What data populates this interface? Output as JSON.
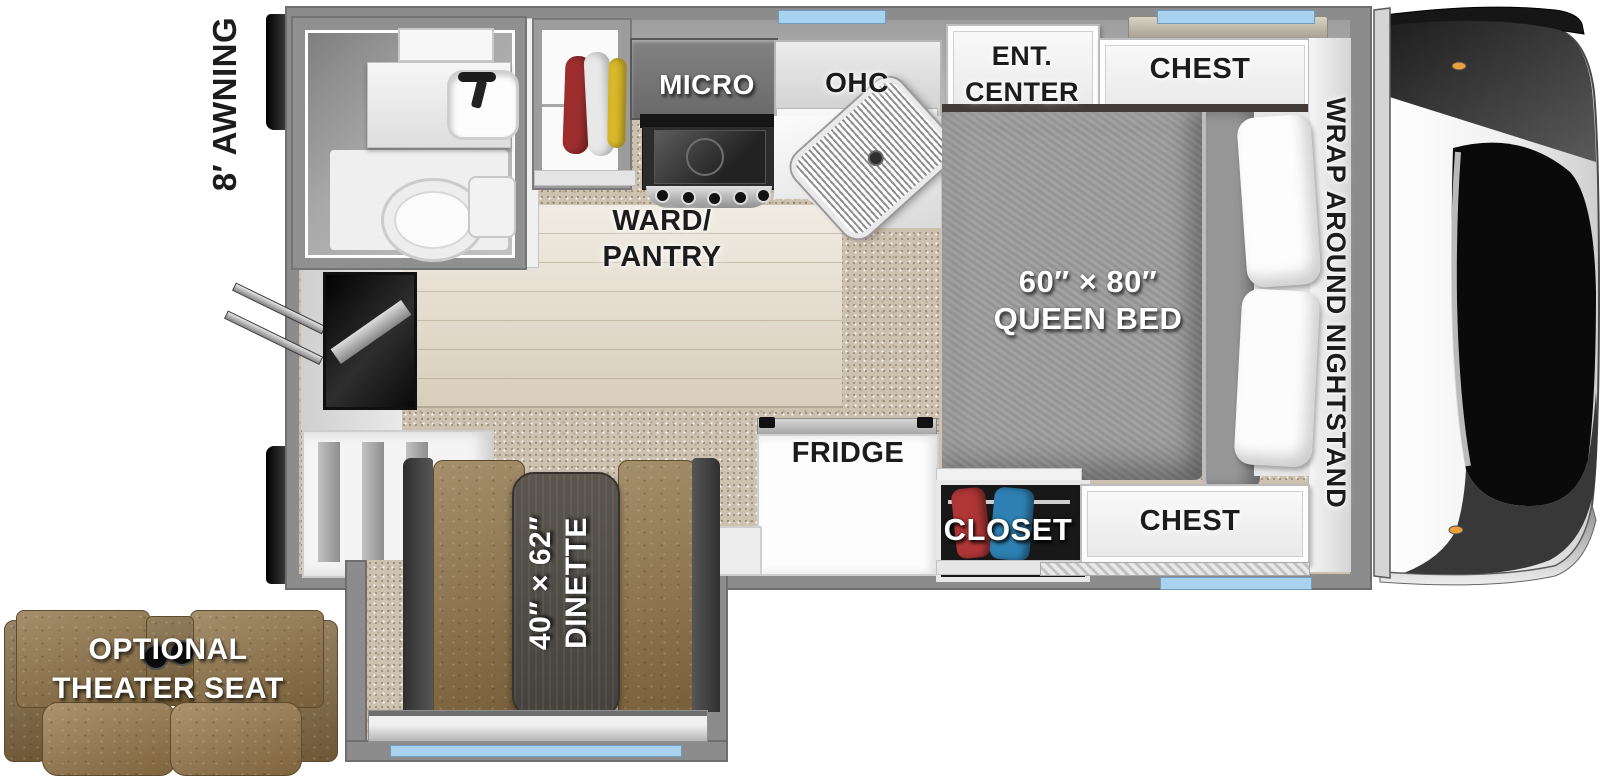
{
  "floorplan": {
    "exterior": {
      "awning_label": "8′ AWNING"
    },
    "kitchen": {
      "micro": "MICRO",
      "ohc": "OHC",
      "ward_pantry_line1": "WARD/",
      "ward_pantry_line2": "PANTRY",
      "fridge": "FRIDGE"
    },
    "bedroom": {
      "ent_center_line1": "ENT.",
      "ent_center_line2": "CENTER",
      "chest_front": "CHEST",
      "bed_size": "60″ × 80″",
      "bed_name": "QUEEN BED",
      "nightstand": "WRAP AROUND NIGHTSTAND",
      "closet": "CLOSET",
      "chest_rear": "CHEST"
    },
    "dinette": {
      "size": "40″ × 62″",
      "name": "DINETTE"
    },
    "options": {
      "theater_seat_line1": "OPTIONAL",
      "theater_seat_line2": "THEATER SEAT"
    }
  },
  "colors": {
    "wall": "#8c8c8c",
    "carpet": "#cdc1b0",
    "wood_floor": "#e2d8c7",
    "window_glass": "#a9d2ee",
    "leather_brown": "#8e7347",
    "blanket_gray": "#9c9c9c",
    "table_wood": "#4e4a45",
    "tv_accent": "#2553ac"
  }
}
